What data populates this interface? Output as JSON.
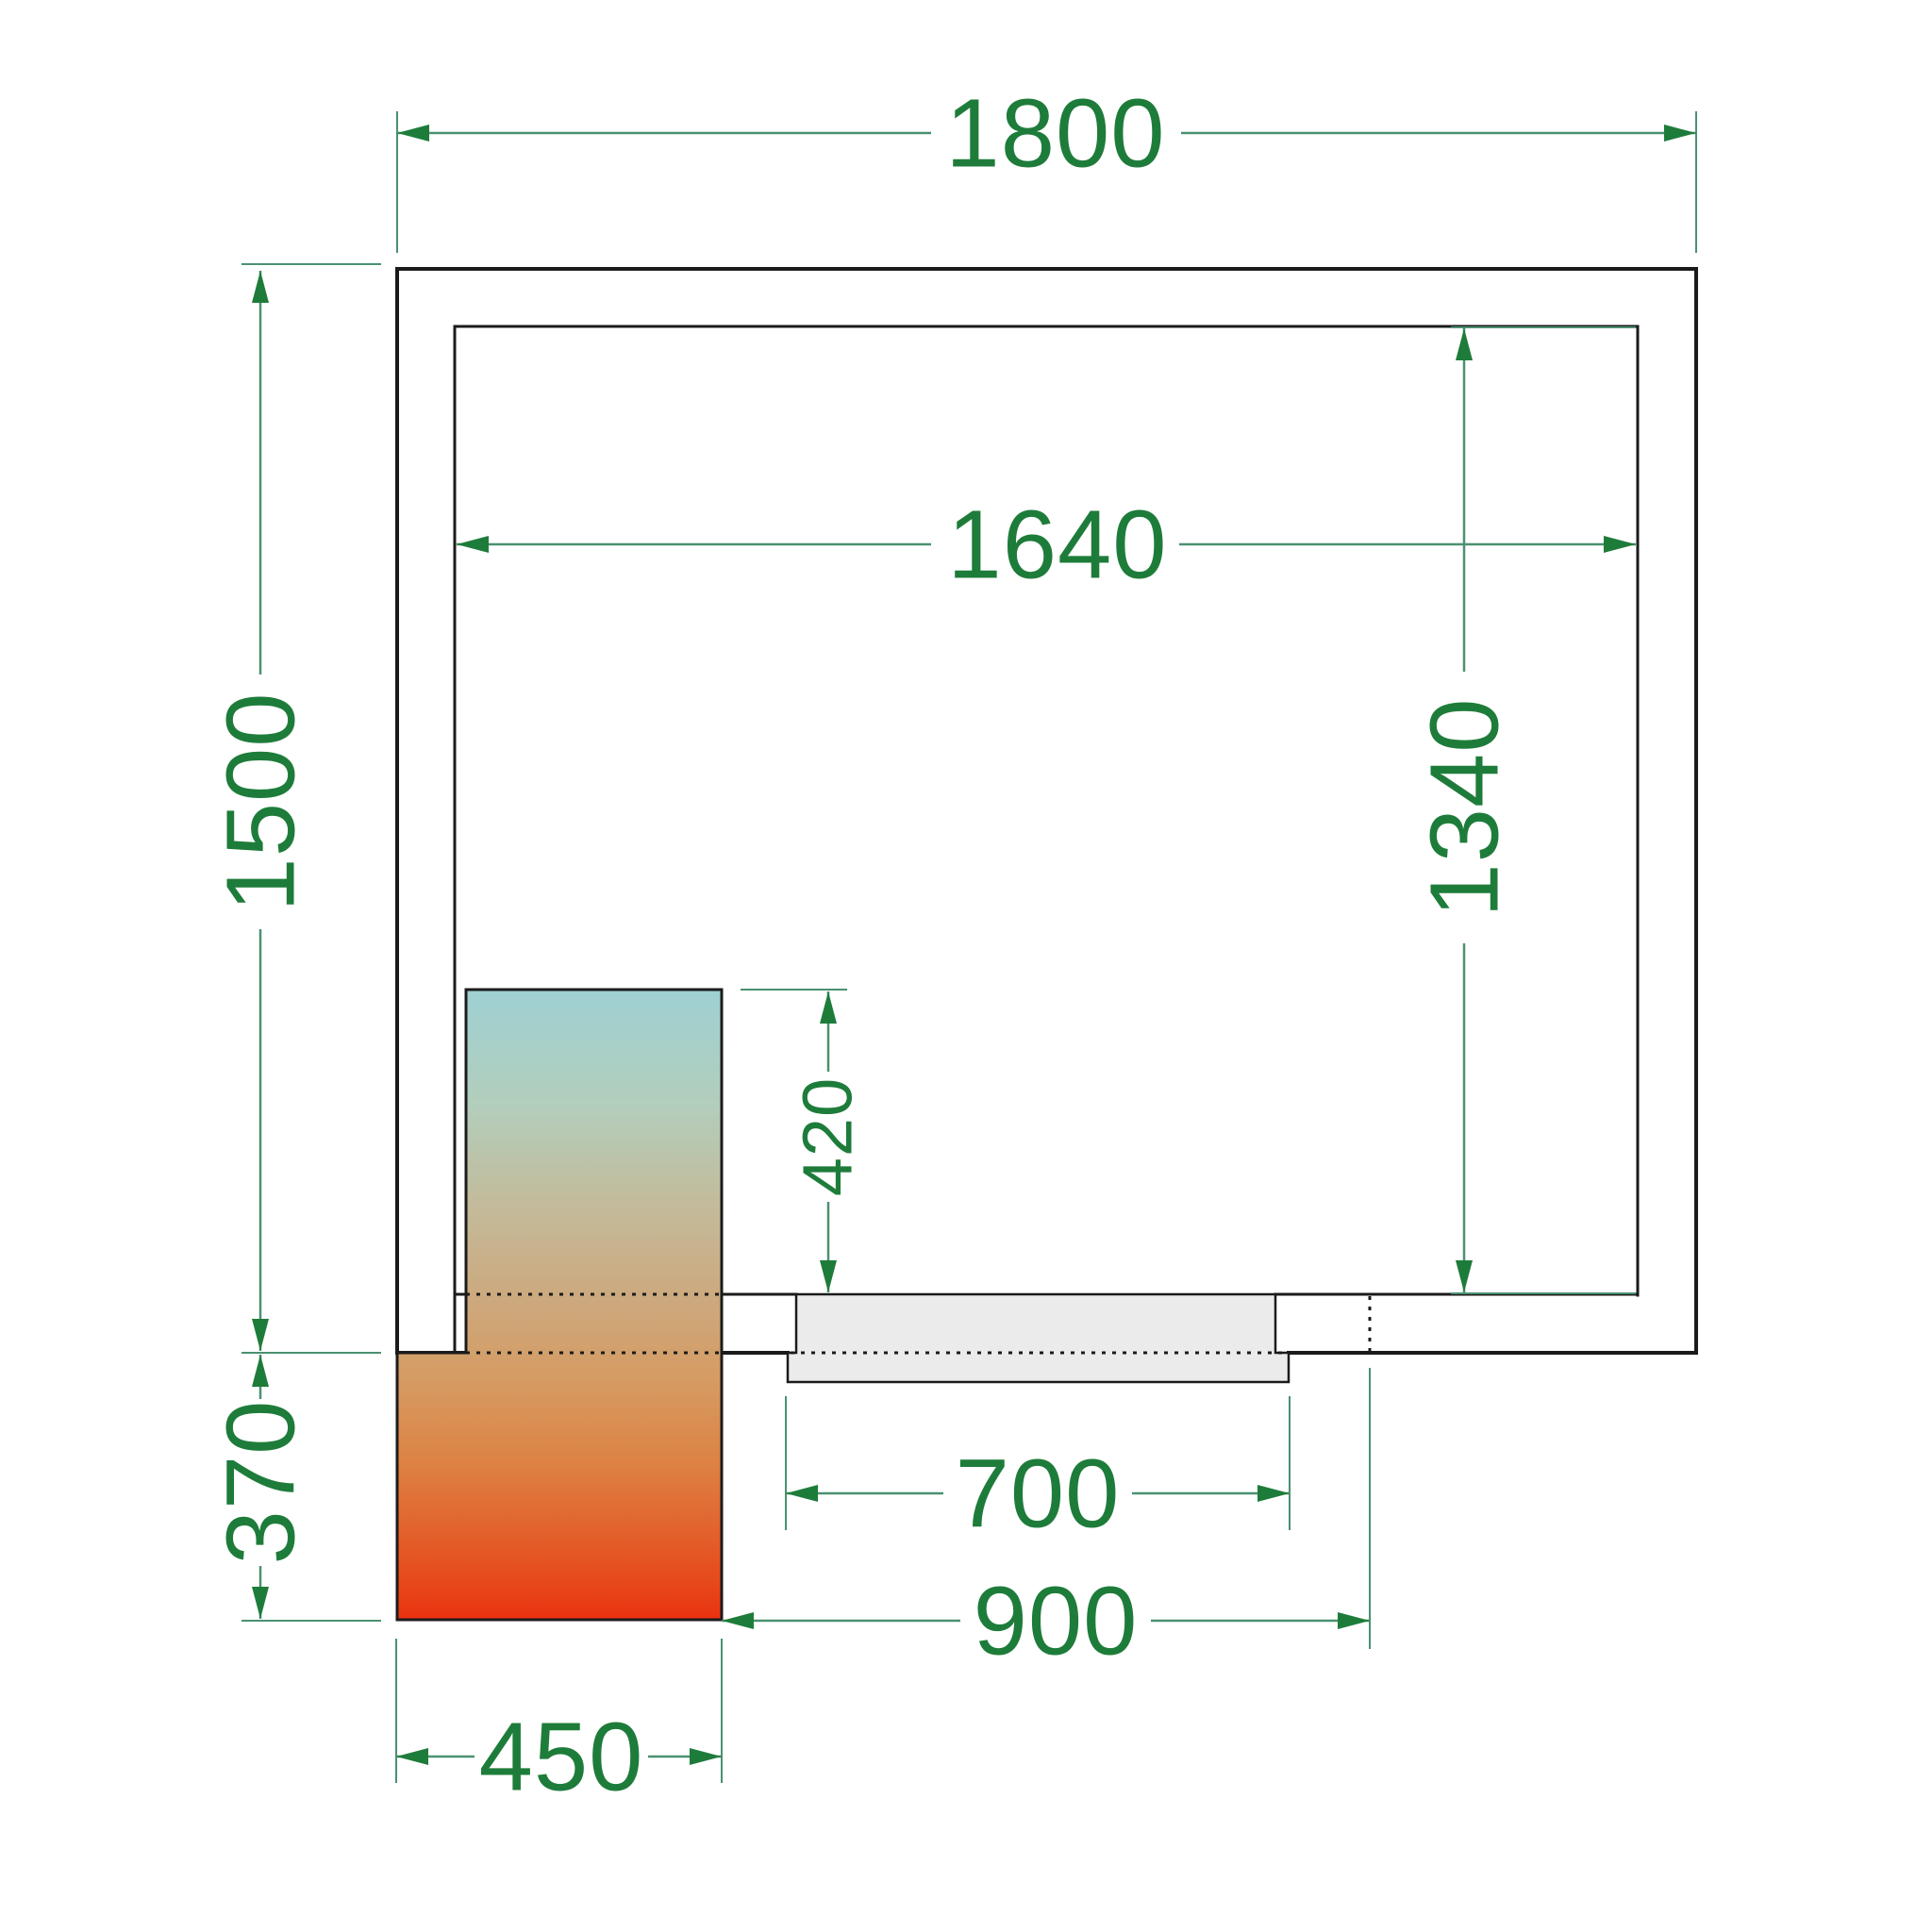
{
  "drawing": {
    "type": "technical-floor-plan",
    "subject": "cold-room plan view with refrigeration unit and door",
    "background": "#ffffff"
  },
  "colors": {
    "wall_line": "#1b1b1b",
    "dim_line": "#4a9171",
    "dim_text": "#1e7c3a",
    "door_fill": "#ebebeb",
    "unit_gradient": [
      "#9ed0d3",
      "#b2cebc",
      "#c3bb9b",
      "#cda87c",
      "#d69a60",
      "#dd8244",
      "#e2622c",
      "#e74618",
      "#ea3110"
    ]
  },
  "dimensions": {
    "outer_width": "1800",
    "outer_depth": "1500",
    "inner_width": "1640",
    "inner_depth": "1340",
    "unit_depth_inside": "420",
    "door_width": "700",
    "door_span": "900",
    "unit_width": "450",
    "unit_depth_outside": "370"
  }
}
